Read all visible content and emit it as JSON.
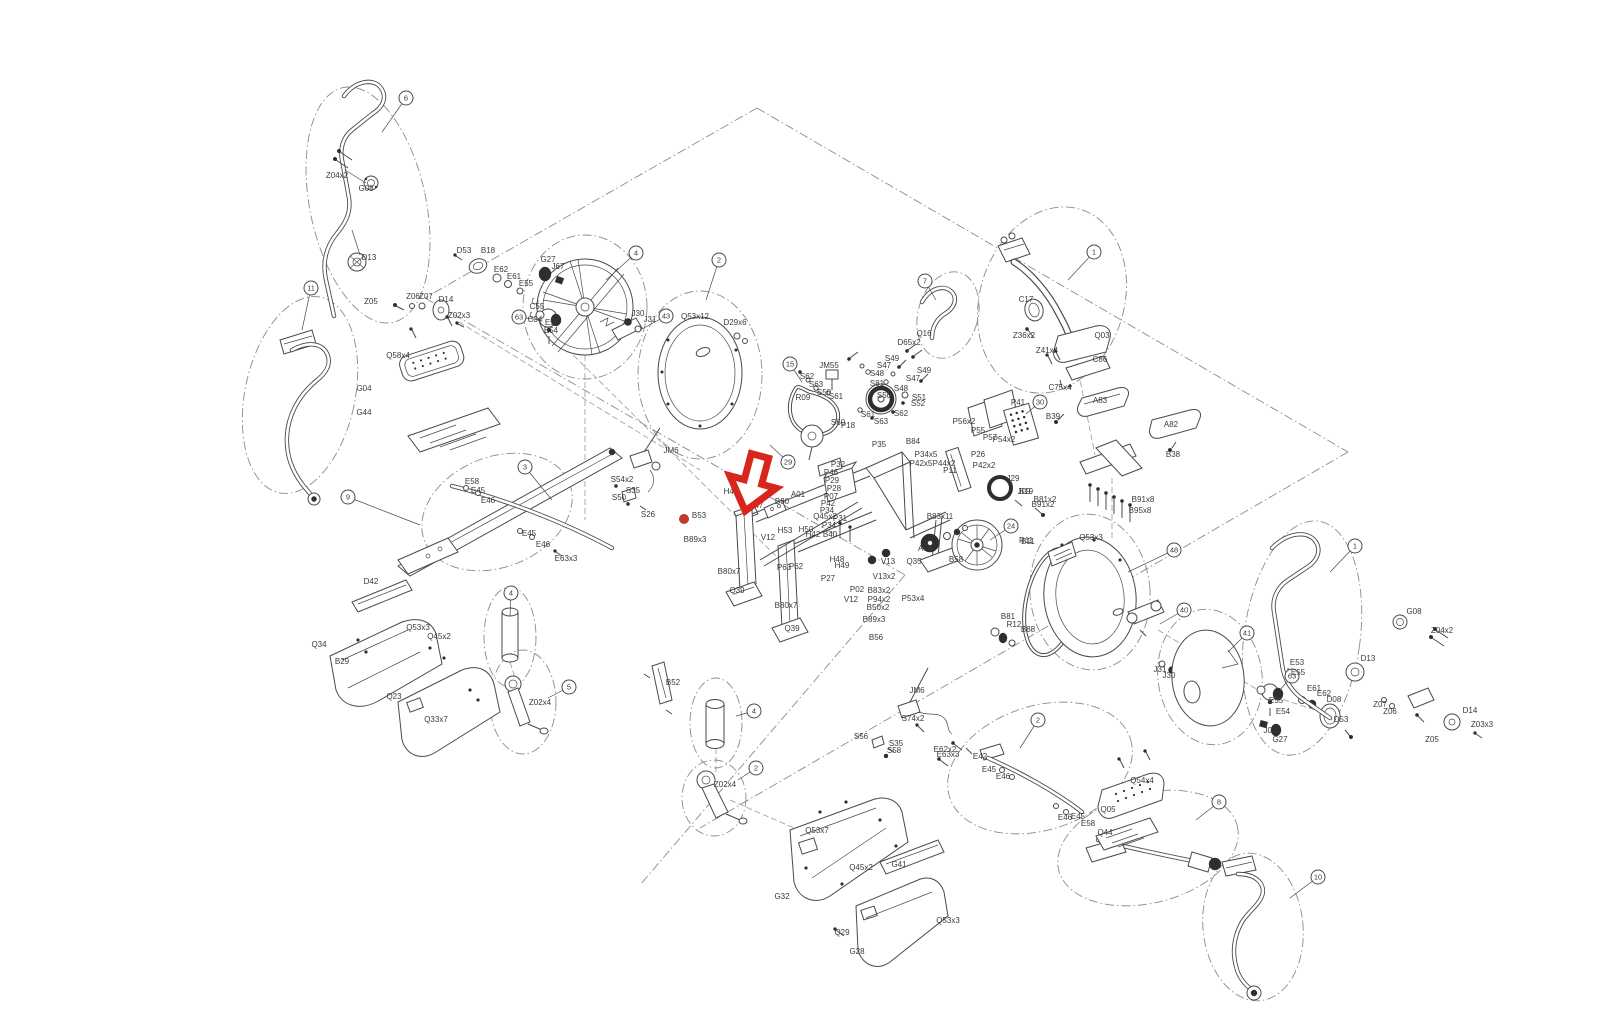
{
  "palette": {
    "line": "#4a4a4a",
    "label": "#3a3a3a",
    "accent_red": "#d9261c",
    "dot_red": "#c0392b",
    "background": "#ffffff"
  },
  "marker": {
    "arrow": {
      "x": 753,
      "y": 482,
      "rotation": 15,
      "color": "#d9261c"
    },
    "dot": {
      "x": 684,
      "y": 519,
      "r": 5,
      "color": "#c0392b"
    }
  },
  "balloons": [
    {
      "n": "6",
      "x": 406,
      "y": 98,
      "lx": 382,
      "ly": 132
    },
    {
      "n": "11",
      "x": 311,
      "y": 288,
      "lx": 302,
      "ly": 330
    },
    {
      "n": "9",
      "x": 348,
      "y": 497,
      "lx": 420,
      "ly": 525
    },
    {
      "n": "3",
      "x": 525,
      "y": 467,
      "lx": 552,
      "ly": 500
    },
    {
      "n": "4",
      "x": 636,
      "y": 253,
      "lx": 606,
      "ly": 280
    },
    {
      "n": "43",
      "x": 666,
      "y": 316,
      "lx": 640,
      "ly": 330
    },
    {
      "n": "63",
      "x": 519,
      "y": 317,
      "lx": 540,
      "ly": 320
    },
    {
      "n": "2",
      "x": 719,
      "y": 260,
      "lx": 706,
      "ly": 300
    },
    {
      "n": "15",
      "x": 790,
      "y": 364,
      "lx": 802,
      "ly": 382
    },
    {
      "n": "29",
      "x": 788,
      "y": 462,
      "lx": 770,
      "ly": 445
    },
    {
      "n": "7",
      "x": 925,
      "y": 281,
      "lx": 936,
      "ly": 300
    },
    {
      "n": "1",
      "x": 1094,
      "y": 252,
      "lx": 1068,
      "ly": 280
    },
    {
      "n": "30",
      "x": 1040,
      "y": 402,
      "lx": 1026,
      "ly": 414
    },
    {
      "n": "24",
      "x": 1011,
      "y": 526,
      "lx": 990,
      "ly": 540
    },
    {
      "n": "48",
      "x": 1174,
      "y": 550,
      "lx": 1128,
      "ly": 572
    },
    {
      "n": "40",
      "x": 1184,
      "y": 610,
      "lx": 1160,
      "ly": 624
    },
    {
      "n": "41",
      "x": 1247,
      "y": 633,
      "lx": 1228,
      "ly": 652
    },
    {
      "n": "63",
      "x": 1292,
      "y": 676,
      "lx": 1280,
      "ly": 690
    },
    {
      "n": "1",
      "x": 1355,
      "y": 546,
      "lx": 1330,
      "ly": 572
    },
    {
      "n": "4",
      "x": 511,
      "y": 593,
      "lx": 510,
      "ly": 616
    },
    {
      "n": "5",
      "x": 569,
      "y": 687,
      "lx": 548,
      "ly": 698
    },
    {
      "n": "4",
      "x": 754,
      "y": 711,
      "lx": 736,
      "ly": 716
    },
    {
      "n": "2",
      "x": 756,
      "y": 768,
      "lx": 738,
      "ly": 780
    },
    {
      "n": "2",
      "x": 1038,
      "y": 720,
      "lx": 1020,
      "ly": 748
    },
    {
      "n": "8",
      "x": 1219,
      "y": 802,
      "lx": 1196,
      "ly": 820
    },
    {
      "n": "10",
      "x": 1318,
      "y": 877,
      "lx": 1290,
      "ly": 898
    }
  ],
  "labels": [
    {
      "t": "Z04x2",
      "x": 337,
      "y": 178
    },
    {
      "t": "G08",
      "x": 366,
      "y": 191
    },
    {
      "t": "D13",
      "x": 369,
      "y": 260
    },
    {
      "t": "Z05",
      "x": 371,
      "y": 304
    },
    {
      "t": "Z06",
      "x": 413,
      "y": 299
    },
    {
      "t": "Z07",
      "x": 426,
      "y": 299
    },
    {
      "t": "D14",
      "x": 446,
      "y": 302
    },
    {
      "t": "Z02x3",
      "x": 459,
      "y": 318
    },
    {
      "t": "Q58x4",
      "x": 398,
      "y": 358
    },
    {
      "t": "G04",
      "x": 364,
      "y": 391
    },
    {
      "t": "G44",
      "x": 364,
      "y": 415
    },
    {
      "t": "E58",
      "x": 472,
      "y": 484
    },
    {
      "t": "E45",
      "x": 478,
      "y": 493
    },
    {
      "t": "E46",
      "x": 488,
      "y": 503
    },
    {
      "t": "E45",
      "x": 529,
      "y": 536
    },
    {
      "t": "E46",
      "x": 543,
      "y": 547
    },
    {
      "t": "E63x3",
      "x": 566,
      "y": 561
    },
    {
      "t": "D53",
      "x": 464,
      "y": 253
    },
    {
      "t": "B18",
      "x": 488,
      "y": 253
    },
    {
      "t": "E62",
      "x": 501,
      "y": 272
    },
    {
      "t": "E61",
      "x": 514,
      "y": 279
    },
    {
      "t": "E55",
      "x": 526,
      "y": 286
    },
    {
      "t": "G27",
      "x": 548,
      "y": 262
    },
    {
      "t": "J67",
      "x": 558,
      "y": 269
    },
    {
      "t": "C55",
      "x": 537,
      "y": 309
    },
    {
      "t": "C34",
      "x": 535,
      "y": 322
    },
    {
      "t": "E55",
      "x": 552,
      "y": 325
    },
    {
      "t": "E54",
      "x": 551,
      "y": 333
    },
    {
      "t": "J30",
      "x": 638,
      "y": 316
    },
    {
      "t": "J31",
      "x": 650,
      "y": 322
    },
    {
      "t": "Q53x12",
      "x": 695,
      "y": 319
    },
    {
      "t": "D29x6",
      "x": 735,
      "y": 325
    },
    {
      "t": "Q16",
      "x": 924,
      "y": 336
    },
    {
      "t": "D65x2",
      "x": 909,
      "y": 345
    },
    {
      "t": "JM55",
      "x": 829,
      "y": 368
    },
    {
      "t": "S62",
      "x": 807,
      "y": 379
    },
    {
      "t": "S63",
      "x": 816,
      "y": 387
    },
    {
      "t": "S50",
      "x": 824,
      "y": 395
    },
    {
      "t": "S61",
      "x": 836,
      "y": 399
    },
    {
      "t": "S60",
      "x": 838,
      "y": 425
    },
    {
      "t": "P18",
      "x": 848,
      "y": 428
    },
    {
      "t": "S81",
      "x": 877,
      "y": 386
    },
    {
      "t": "S48",
      "x": 877,
      "y": 376
    },
    {
      "t": "S47",
      "x": 884,
      "y": 368
    },
    {
      "t": "S49",
      "x": 892,
      "y": 361
    },
    {
      "t": "S50",
      "x": 884,
      "y": 398
    },
    {
      "t": "S61",
      "x": 868,
      "y": 417
    },
    {
      "t": "S63",
      "x": 881,
      "y": 424
    },
    {
      "t": "S62",
      "x": 901,
      "y": 416
    },
    {
      "t": "S49",
      "x": 924,
      "y": 373
    },
    {
      "t": "S47",
      "x": 913,
      "y": 381
    },
    {
      "t": "S48",
      "x": 901,
      "y": 391
    },
    {
      "t": "S51",
      "x": 919,
      "y": 400
    },
    {
      "t": "S52",
      "x": 918,
      "y": 406
    },
    {
      "t": "R09",
      "x": 803,
      "y": 400
    },
    {
      "t": "JM6",
      "x": 671,
      "y": 453
    },
    {
      "t": "S54x2",
      "x": 622,
      "y": 482
    },
    {
      "t": "S35",
      "x": 633,
      "y": 493
    },
    {
      "t": "S50",
      "x": 619,
      "y": 500
    },
    {
      "t": "S26",
      "x": 648,
      "y": 517
    },
    {
      "t": "H49",
      "x": 731,
      "y": 494
    },
    {
      "t": "H48",
      "x": 746,
      "y": 503
    },
    {
      "t": "H47",
      "x": 756,
      "y": 508
    },
    {
      "t": "B80",
      "x": 782,
      "y": 504
    },
    {
      "t": "A01",
      "x": 798,
      "y": 497
    },
    {
      "t": "Q45x2",
      "x": 825,
      "y": 519
    },
    {
      "t": "P34",
      "x": 829,
      "y": 528
    },
    {
      "t": "B40",
      "x": 830,
      "y": 537
    },
    {
      "t": "H53",
      "x": 785,
      "y": 533
    },
    {
      "t": "H50",
      "x": 806,
      "y": 532
    },
    {
      "t": "H42",
      "x": 813,
      "y": 537
    },
    {
      "t": "H48",
      "x": 837,
      "y": 562
    },
    {
      "t": "H49",
      "x": 842,
      "y": 568
    },
    {
      "t": "V12",
      "x": 768,
      "y": 540
    },
    {
      "t": "B53",
      "x": 699,
      "y": 518
    },
    {
      "t": "B89x3",
      "x": 695,
      "y": 542
    },
    {
      "t": "B80x7",
      "x": 729,
      "y": 574
    },
    {
      "t": "Q39",
      "x": 737,
      "y": 593
    },
    {
      "t": "P63",
      "x": 784,
      "y": 570
    },
    {
      "t": "P62",
      "x": 796,
      "y": 569
    },
    {
      "t": "P27",
      "x": 828,
      "y": 581
    },
    {
      "t": "B80x7",
      "x": 786,
      "y": 608
    },
    {
      "t": "Q39",
      "x": 792,
      "y": 631
    },
    {
      "t": "P02",
      "x": 857,
      "y": 592
    },
    {
      "t": "V12",
      "x": 851,
      "y": 602
    },
    {
      "t": "B83x2",
      "x": 879,
      "y": 593
    },
    {
      "t": "P94x2",
      "x": 879,
      "y": 602
    },
    {
      "t": "B50x2",
      "x": 878,
      "y": 610
    },
    {
      "t": "B89x3",
      "x": 874,
      "y": 622
    },
    {
      "t": "B56",
      "x": 876,
      "y": 640
    },
    {
      "t": "V13",
      "x": 888,
      "y": 564
    },
    {
      "t": "V13x2",
      "x": 884,
      "y": 579
    },
    {
      "t": "B84",
      "x": 913,
      "y": 444
    },
    {
      "t": "P35",
      "x": 879,
      "y": 447
    },
    {
      "t": "P32",
      "x": 838,
      "y": 467
    },
    {
      "t": "P46",
      "x": 831,
      "y": 475
    },
    {
      "t": "P29",
      "x": 832,
      "y": 483
    },
    {
      "t": "P28",
      "x": 834,
      "y": 491
    },
    {
      "t": "P07",
      "x": 831,
      "y": 499
    },
    {
      "t": "P42",
      "x": 828,
      "y": 506
    },
    {
      "t": "P34",
      "x": 827,
      "y": 513
    },
    {
      "t": "P31",
      "x": 840,
      "y": 521
    },
    {
      "t": "P34x5",
      "x": 926,
      "y": 457
    },
    {
      "t": "P42x5",
      "x": 921,
      "y": 466
    },
    {
      "t": "P44x2",
      "x": 944,
      "y": 466
    },
    {
      "t": "P11",
      "x": 950,
      "y": 473
    },
    {
      "t": "P26",
      "x": 978,
      "y": 457
    },
    {
      "t": "P42x2",
      "x": 984,
      "y": 468
    },
    {
      "t": "P56x2",
      "x": 964,
      "y": 424
    },
    {
      "t": "P55",
      "x": 978,
      "y": 433
    },
    {
      "t": "P57",
      "x": 990,
      "y": 440
    },
    {
      "t": "P54x2",
      "x": 1004,
      "y": 442
    },
    {
      "t": "Q35",
      "x": 914,
      "y": 564
    },
    {
      "t": "P53x4",
      "x": 913,
      "y": 601
    },
    {
      "t": "B83x11",
      "x": 940,
      "y": 519
    },
    {
      "t": "J29",
      "x": 1013,
      "y": 481
    },
    {
      "t": "J09",
      "x": 1024,
      "y": 494
    },
    {
      "t": "B81x2",
      "x": 1045,
      "y": 502
    },
    {
      "t": "AT4",
      "x": 925,
      "y": 551
    },
    {
      "t": "B58",
      "x": 956,
      "y": 562
    },
    {
      "t": "R11",
      "x": 1026,
      "y": 543
    },
    {
      "t": "B81",
      "x": 1008,
      "y": 619
    },
    {
      "t": "R12",
      "x": 1014,
      "y": 627
    },
    {
      "t": "B88",
      "x": 1028,
      "y": 632
    },
    {
      "t": "C17",
      "x": 1026,
      "y": 302
    },
    {
      "t": "Z36x2",
      "x": 1024,
      "y": 338
    },
    {
      "t": "Q03",
      "x": 1102,
      "y": 338
    },
    {
      "t": "Z41x4",
      "x": 1047,
      "y": 353
    },
    {
      "t": "C86",
      "x": 1100,
      "y": 362
    },
    {
      "t": "C75x4",
      "x": 1060,
      "y": 390
    },
    {
      "t": "P41",
      "x": 1018,
      "y": 405
    },
    {
      "t": "B39",
      "x": 1053,
      "y": 419
    },
    {
      "t": "A83",
      "x": 1100,
      "y": 403
    },
    {
      "t": "A82",
      "x": 1171,
      "y": 427
    },
    {
      "t": "B38",
      "x": 1173,
      "y": 457
    },
    {
      "t": "B19",
      "x": 1026,
      "y": 494
    },
    {
      "t": "B91x2",
      "x": 1043,
      "y": 507
    },
    {
      "t": "B91x8",
      "x": 1143,
      "y": 502
    },
    {
      "t": "B95x8",
      "x": 1140,
      "y": 513
    },
    {
      "t": "Q53x3",
      "x": 1091,
      "y": 540
    },
    {
      "t": "B11",
      "x": 1028,
      "y": 544
    },
    {
      "t": "E53",
      "x": 1297,
      "y": 665
    },
    {
      "t": "E55",
      "x": 1298,
      "y": 675
    },
    {
      "t": "E55",
      "x": 1276,
      "y": 703
    },
    {
      "t": "E54",
      "x": 1283,
      "y": 714
    },
    {
      "t": "J07",
      "x": 1270,
      "y": 733
    },
    {
      "t": "G27",
      "x": 1280,
      "y": 742
    },
    {
      "t": "E61",
      "x": 1314,
      "y": 691
    },
    {
      "t": "E62",
      "x": 1324,
      "y": 696
    },
    {
      "t": "D08",
      "x": 1334,
      "y": 702
    },
    {
      "t": "D53",
      "x": 1341,
      "y": 722
    },
    {
      "t": "J31",
      "x": 1160,
      "y": 672
    },
    {
      "t": "J30",
      "x": 1169,
      "y": 678
    },
    {
      "t": "G08",
      "x": 1414,
      "y": 614
    },
    {
      "t": "Z04x2",
      "x": 1442,
      "y": 633
    },
    {
      "t": "D13",
      "x": 1368,
      "y": 661
    },
    {
      "t": "Z07",
      "x": 1380,
      "y": 707
    },
    {
      "t": "Z06",
      "x": 1390,
      "y": 714
    },
    {
      "t": "Z05",
      "x": 1432,
      "y": 742
    },
    {
      "t": "D14",
      "x": 1470,
      "y": 713
    },
    {
      "t": "Z03x3",
      "x": 1482,
      "y": 727
    },
    {
      "t": "E62x2",
      "x": 945,
      "y": 752
    },
    {
      "t": "E42",
      "x": 980,
      "y": 759
    },
    {
      "t": "E45",
      "x": 989,
      "y": 772
    },
    {
      "t": "E46",
      "x": 1003,
      "y": 779
    },
    {
      "t": "E46",
      "x": 1065,
      "y": 820
    },
    {
      "t": "E45",
      "x": 1078,
      "y": 819
    },
    {
      "t": "E58",
      "x": 1088,
      "y": 826
    },
    {
      "t": "Q54x4",
      "x": 1142,
      "y": 783
    },
    {
      "t": "Q05",
      "x": 1108,
      "y": 812
    },
    {
      "t": "Q44",
      "x": 1105,
      "y": 835
    },
    {
      "t": "B52",
      "x": 673,
      "y": 685
    },
    {
      "t": "Z02x4",
      "x": 725,
      "y": 787
    },
    {
      "t": "JM6",
      "x": 917,
      "y": 693
    },
    {
      "t": "S74x2",
      "x": 913,
      "y": 721
    },
    {
      "t": "S56",
      "x": 861,
      "y": 739
    },
    {
      "t": "S35",
      "x": 896,
      "y": 746
    },
    {
      "t": "S58",
      "x": 894,
      "y": 753
    },
    {
      "t": "E63x3",
      "x": 948,
      "y": 757
    },
    {
      "t": "Q53x7",
      "x": 817,
      "y": 833
    },
    {
      "t": "Q45x2",
      "x": 861,
      "y": 870
    },
    {
      "t": "G32",
      "x": 782,
      "y": 899
    },
    {
      "t": "G41",
      "x": 899,
      "y": 867
    },
    {
      "t": "Q53x3",
      "x": 948,
      "y": 923
    },
    {
      "t": "Q29",
      "x": 842,
      "y": 935
    },
    {
      "t": "G28",
      "x": 857,
      "y": 954
    },
    {
      "t": "D42",
      "x": 371,
      "y": 584
    },
    {
      "t": "Q53x3",
      "x": 418,
      "y": 630
    },
    {
      "t": "Q45x2",
      "x": 439,
      "y": 639
    },
    {
      "t": "Q34",
      "x": 319,
      "y": 647
    },
    {
      "t": "B29",
      "x": 342,
      "y": 664
    },
    {
      "t": "Q23",
      "x": 394,
      "y": 699
    },
    {
      "t": "Q33x7",
      "x": 436,
      "y": 722
    },
    {
      "t": "Z02x4",
      "x": 540,
      "y": 705
    }
  ]
}
